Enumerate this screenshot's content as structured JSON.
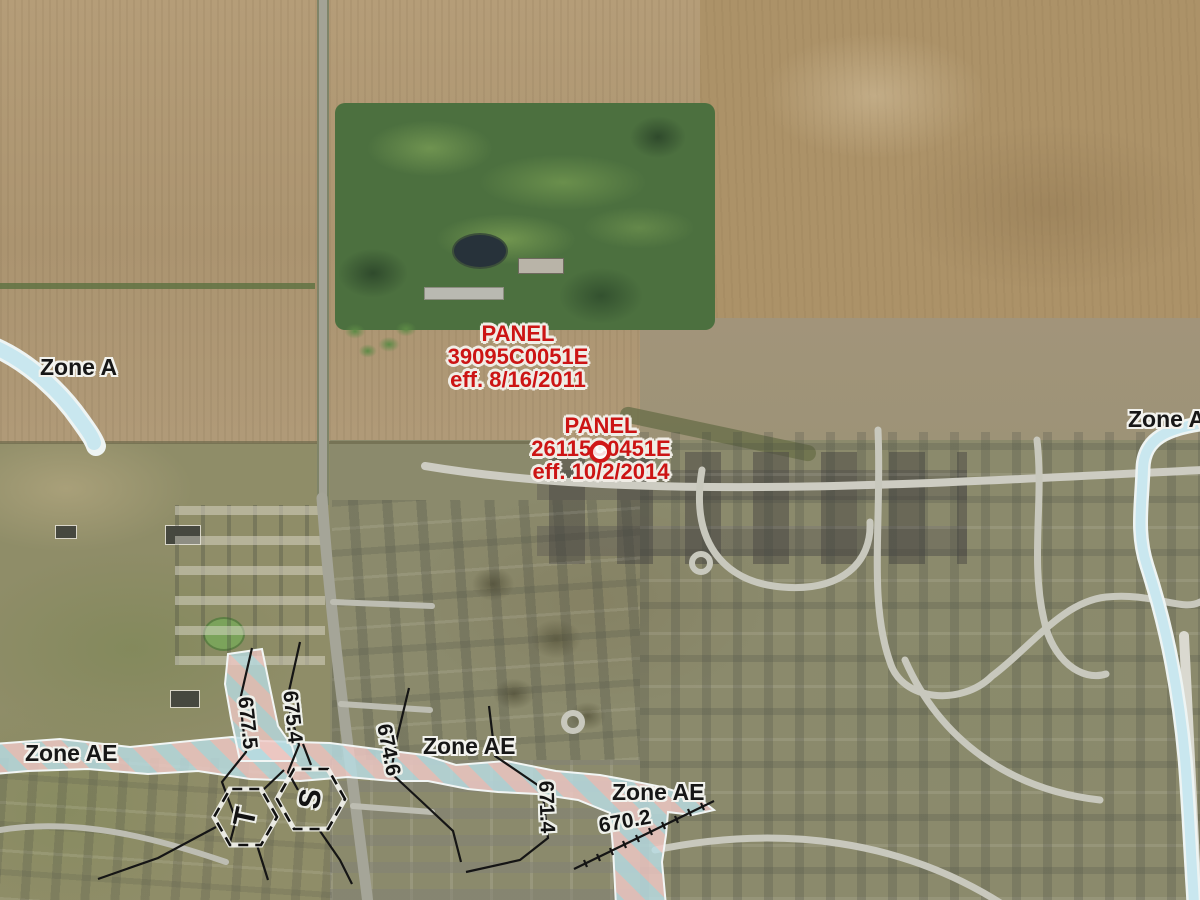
{
  "map": {
    "description": "FEMA flood hazard (FIRM) overlay on aerial imagery",
    "flood_zone_labels": {
      "zone_a_west": "Zone A",
      "zone_a_east": "Zone A",
      "zone_ae_west": "Zone AE",
      "zone_ae_center": "Zone AE",
      "zone_ae_east": "Zone AE"
    },
    "firm_panels": [
      {
        "title": "PANEL",
        "number": "39095C0051E",
        "effective": "eff. 8/16/2011"
      },
      {
        "title": "PANEL",
        "number": "26115C0451E",
        "effective": "eff. 10/2/2014"
      }
    ],
    "base_flood_elevations": [
      {
        "value": "677.5"
      },
      {
        "value": "675.4"
      },
      {
        "value": "674.6"
      },
      {
        "value": "671.4"
      },
      {
        "value": "670.2"
      }
    ],
    "cross_sections": [
      {
        "letter": "T"
      },
      {
        "letter": "S"
      }
    ],
    "colors": {
      "zone_a_fill": "#c9e7ef",
      "zone_ae_stripe_blue": "#b9dde4",
      "zone_ae_stripe_pink": "#f0c9c6",
      "panel_label_red": "#cc1414",
      "map_label_black": "#171717"
    }
  }
}
